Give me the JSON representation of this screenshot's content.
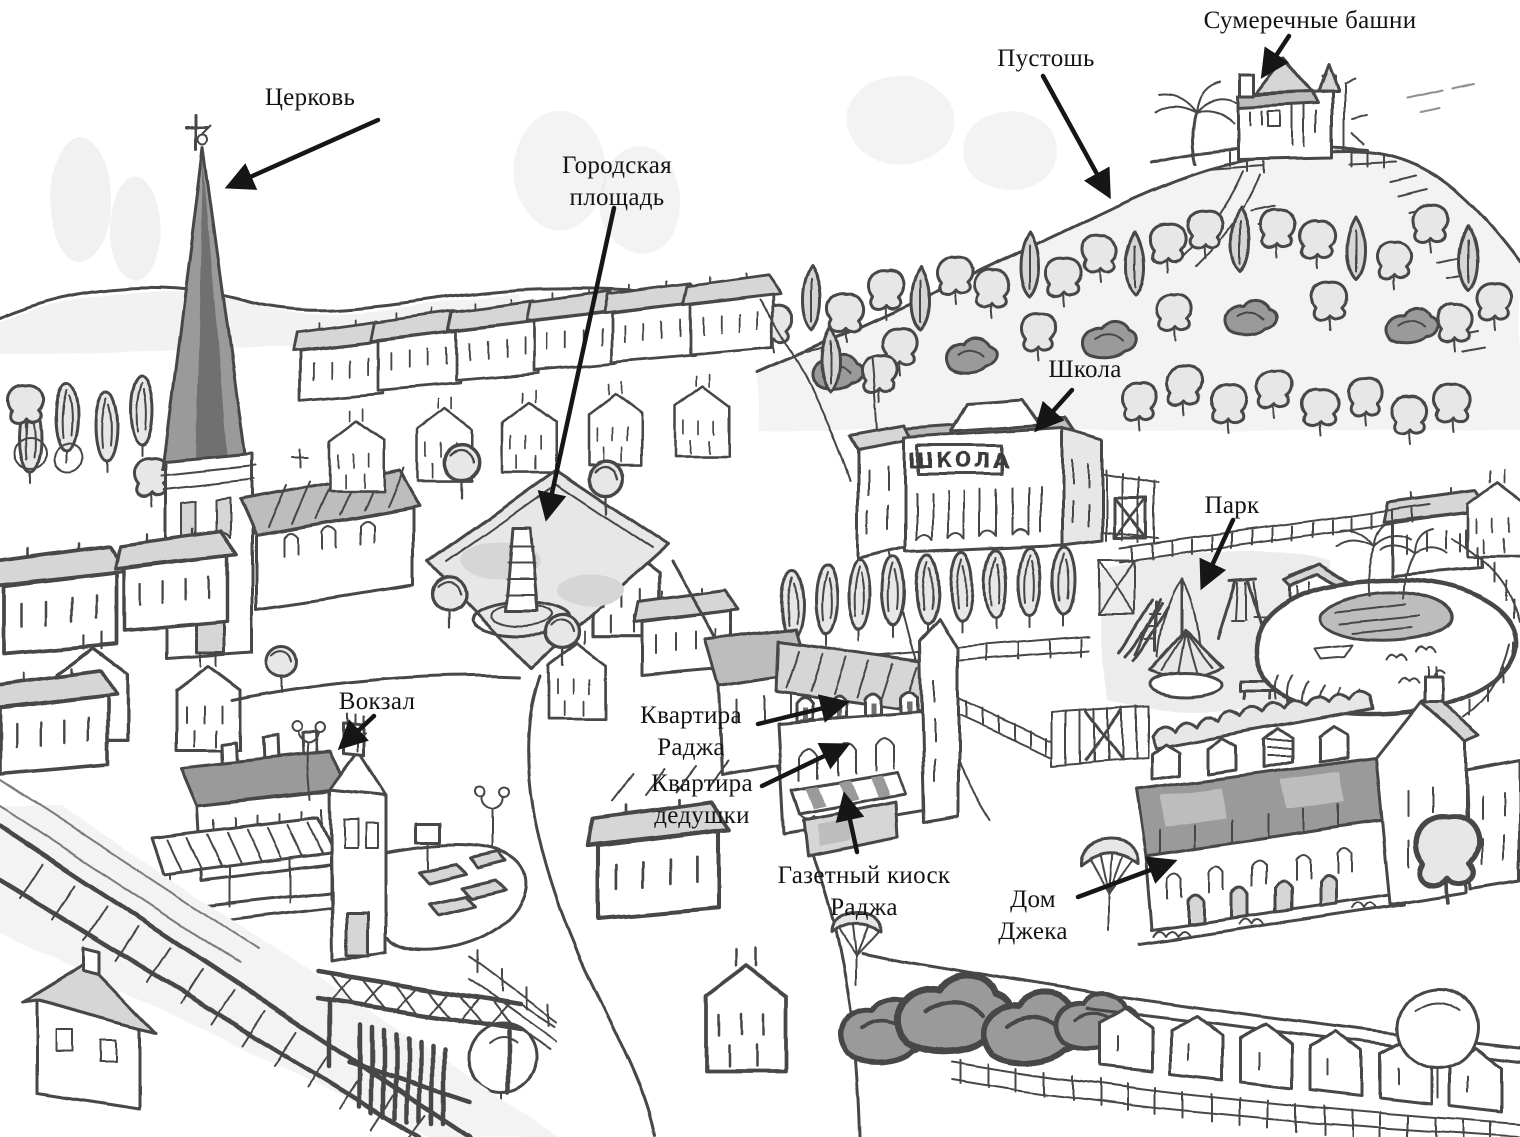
{
  "map": {
    "labels": {
      "church": "Церковь",
      "town_square": "Городская площадь",
      "heath": "Пустошь",
      "twilight_towers": "Сумеречные башни",
      "school": "Школа",
      "park": "Парк",
      "station": "Вокзал",
      "raj_apartment": "Квартира Раджа",
      "grandpa_apartment": "Квартира дедушки",
      "raj_newsstand": "Газетный киоск Раджа",
      "jack_house": "Дом Джека"
    },
    "signs": {
      "school_building": "ШКОЛА"
    },
    "palette": {
      "ink": "#474747",
      "label_ink": "#141414",
      "arrow": "#161616",
      "paper": "#ffffff",
      "wash_light": "#ececec",
      "wash_mid": "#d6d6d6",
      "wash_dark": "#9a9a9a"
    }
  }
}
